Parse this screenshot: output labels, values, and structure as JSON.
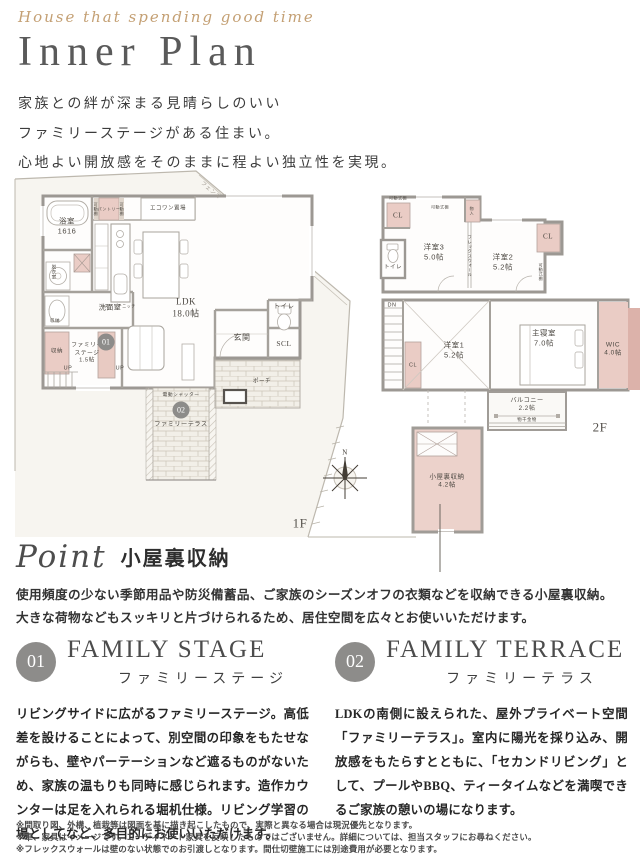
{
  "header": {
    "script": "House that spending good time",
    "title": "Inner Plan",
    "intro_lines": [
      "家族との絆が深まる見晴らしのいい",
      "ファミリーステージがある住まい。",
      "心地よい開放感をそのままに程よい独立性を実現。"
    ]
  },
  "colors": {
    "accent_pink": "#eaccc5",
    "wall_gray": "#9c9893",
    "badge_gray": "#8d8c8a",
    "script_tan": "#c4a074",
    "title_gray": "#5a5a5a"
  },
  "floorplan": {
    "f1": {
      "name": "1F",
      "labels": [
        {
          "t": "フェンス",
          "x": 200,
          "y": 25,
          "fs": 5.5,
          "rot": 40,
          "c": "#a09a90"
        },
        {
          "t": "浴室\n1616",
          "x": 57,
          "y": 60,
          "fs": 7.5
        },
        {
          "t": "脱衣室",
          "x": 44,
          "y": 106,
          "fs": 4.5,
          "vert": true
        },
        {
          "t": "洗面室",
          "x": 100,
          "y": 142,
          "fs": 7
        },
        {
          "t": "収納",
          "x": 45,
          "y": 155,
          "fs": 4.5
        },
        {
          "t": "可動棚",
          "x": 86,
          "y": 43,
          "fs": 4,
          "vert": true
        },
        {
          "t": "パントリー",
          "x": 99,
          "y": 43,
          "fs": 4
        },
        {
          "t": "可動棚",
          "x": 112,
          "y": 43,
          "fs": 4,
          "vert": true
        },
        {
          "t": "エコワン置場",
          "x": 158,
          "y": 43,
          "fs": 5.5
        },
        {
          "t": "LDK\n18.0帖",
          "x": 176,
          "y": 142,
          "fs": 9,
          "serif": true
        },
        {
          "t": "スイッチニッチ",
          "x": 110,
          "y": 140,
          "fs": 4
        },
        {
          "t": "収納",
          "x": 47,
          "y": 186,
          "fs": 5.5
        },
        {
          "t": "ファミリー\nステージ\n1.5帖",
          "x": 77,
          "y": 188,
          "fs": 5.8
        },
        {
          "badge": "01",
          "x": 96,
          "y": 176
        },
        {
          "t": "UP",
          "x": 58,
          "y": 203,
          "fs": 5.5
        },
        {
          "t": "UP",
          "x": 110,
          "y": 203,
          "fs": 5.5
        },
        {
          "t": "玄関",
          "x": 232,
          "y": 172,
          "fs": 8
        },
        {
          "t": "トイレ",
          "x": 274,
          "y": 141,
          "fs": 6.5
        },
        {
          "t": "SCL",
          "x": 274,
          "y": 178,
          "fs": 7.5,
          "serif": true
        },
        {
          "t": "ポーチ",
          "x": 252,
          "y": 216,
          "fs": 5.5
        },
        {
          "t": "電動シャッター",
          "x": 171,
          "y": 230,
          "fs": 4.8
        },
        {
          "badge": "02",
          "x": 171,
          "y": 244
        },
        {
          "t": "ファミリーテラス",
          "x": 171,
          "y": 259,
          "fs": 6.2
        },
        {
          "t": "N",
          "x": 335,
          "y": 287,
          "fs": 7,
          "serif": true,
          "c": "#3e3931"
        },
        {
          "t": "1F",
          "x": 290,
          "y": 358,
          "fs": 13,
          "serif": true,
          "c": "#55514c"
        }
      ]
    },
    "f2": {
      "name": "2F",
      "labels": [
        {
          "t": "可動式棚",
          "x": 22,
          "y": 8,
          "fs": 4
        },
        {
          "t": "可動式棚",
          "x": 64,
          "y": 17,
          "fs": 4
        },
        {
          "t": "CL",
          "x": 22,
          "y": 26,
          "fs": 7,
          "serif": true
        },
        {
          "t": "物入",
          "x": 96,
          "y": 21,
          "fs": 4,
          "vert": true
        },
        {
          "t": "洋室3\n5.0帖",
          "x": 58,
          "y": 62,
          "fs": 7.5
        },
        {
          "t": "フレックスウォール",
          "x": 94,
          "y": 66,
          "fs": 4.2,
          "vert": true
        },
        {
          "t": "洋室2\n5.2帖",
          "x": 127,
          "y": 72,
          "fs": 7.5
        },
        {
          "t": "CL",
          "x": 172,
          "y": 47,
          "fs": 7,
          "serif": true
        },
        {
          "t": "可動式棚",
          "x": 165,
          "y": 82,
          "fs": 4,
          "vert": true
        },
        {
          "t": "トイレ",
          "x": 17,
          "y": 78,
          "fs": 5.5
        },
        {
          "t": "DN",
          "x": 16,
          "y": 116,
          "fs": 5.5
        },
        {
          "t": "CL",
          "x": 37,
          "y": 176,
          "fs": 5.5
        },
        {
          "t": "洋室1\n5.2帖",
          "x": 78,
          "y": 160,
          "fs": 7.5
        },
        {
          "t": "主寝室\n7.0帖",
          "x": 168,
          "y": 148,
          "fs": 7.5
        },
        {
          "t": "WIC\n4.0帖",
          "x": 237,
          "y": 160,
          "fs": 6.5
        },
        {
          "t": "バルコニー\n2.2帖",
          "x": 151,
          "y": 215,
          "fs": 6.2
        },
        {
          "t": "物干金物",
          "x": 151,
          "y": 230,
          "fs": 4.4
        },
        {
          "t": "2F",
          "x": 224,
          "y": 238,
          "fs": 13,
          "serif": true,
          "c": "#55514c"
        },
        {
          "t": "小屋裏収納\n4.2帖",
          "x": 71,
          "y": 292,
          "fs": 6.5
        }
      ]
    }
  },
  "point": {
    "script": "Point",
    "title": "小屋裏収納",
    "body": [
      "使用頻度の少ない季節用品や防災備蓄品、ご家族のシーズンオフの衣類などを収納できる小屋裏収納。",
      "大きな荷物などもスッキリと片づけられるため、居住空間を広々とお使いいただけます。"
    ]
  },
  "sections": [
    {
      "num": "01",
      "heading": "FAMILY STAGE",
      "sub": "ファミリーステージ",
      "body": "リビングサイドに広がるファミリーステージ。高低差を設けることによって、別空間の印象をもたせながらも、壁やパーテーションなど遮るものがないため、家族の温もりも同時に感じられます。造作カウンターは足を入れられる堀机仕様。リビング学習の場としてなど、多目的にお使いいただけます。"
    },
    {
      "num": "02",
      "heading": "FAMILY TERRACE",
      "sub": "ファミリーテラス",
      "body": "LDKの南側に設えられた、屋外プライベート空間「ファミリーテラス」。室内に陽光を採り込み、開放感をもたらすとともに、「セカンドリビング」として、プールやBBQ、ティータイムなどを満喫できるご家族の憩いの場になります。"
    }
  ],
  "footer": {
    "lines": [
      "※間取り図、外構、植栽等は図面を基に描き起こしたもので、実際と異なる場合は現況優先となります。",
      "※車、家具はイメージです。コーディネート家具を反映したものではございません。詳細については、担当スタッフにお尋ねください。",
      "※フレックスウォールは壁のない状態でのお引渡しとなります。間仕切壁施工には別途費用が必要となります。"
    ]
  }
}
